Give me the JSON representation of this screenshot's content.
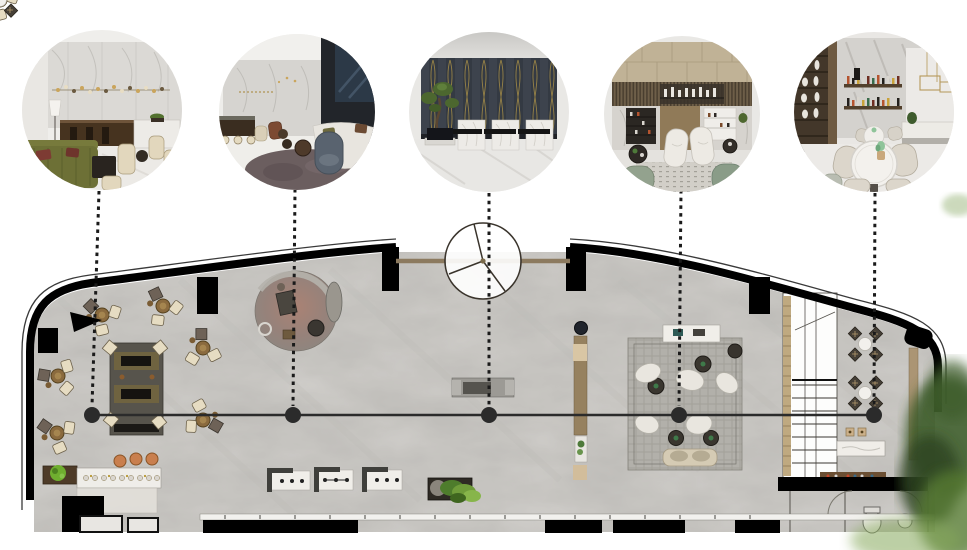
{
  "page": {
    "kind": "interior-design-floor-plan-presentation",
    "title": ""
  },
  "callouts": [
    {
      "id": 1,
      "scene": "lobby-bar-lounge-render",
      "node_x": 92,
      "circle_cx": 102
    },
    {
      "id": 2,
      "scene": "lounge-seating-render",
      "node_x": 293,
      "circle_cx": 295
    },
    {
      "id": 3,
      "scene": "reception-desks-render",
      "node_x": 489,
      "circle_cx": 489
    },
    {
      "id": 4,
      "scene": "bar-mezzanine-render",
      "node_x": 679,
      "circle_cx": 680
    },
    {
      "id": 5,
      "scene": "cafe-bar-tables-render",
      "node_x": 874,
      "circle_cx": 874
    }
  ],
  "section_line": {
    "y": 415,
    "x_start": 92,
    "x_end": 874
  },
  "colors": {
    "wall_black": "#000000",
    "floor_base": "#d2d0cc",
    "marble_speckle": "#8f8d89",
    "section_line": "#2b2b2b",
    "leader_dots": "#1a1a1a",
    "entry_wood": "#8c7a5f",
    "rug_gray": "#b2b0aa",
    "rug_dark": "#57544c",
    "oval_rug": "#9a7c6e",
    "chair_cream": "#e6dcc2",
    "table_wood": "#8a6a3e",
    "sofa_green": "#6d7036",
    "accent_gold": "#b89a5a",
    "foliage_dark": "#3e5c2a",
    "foliage_light": "#86a85c"
  }
}
